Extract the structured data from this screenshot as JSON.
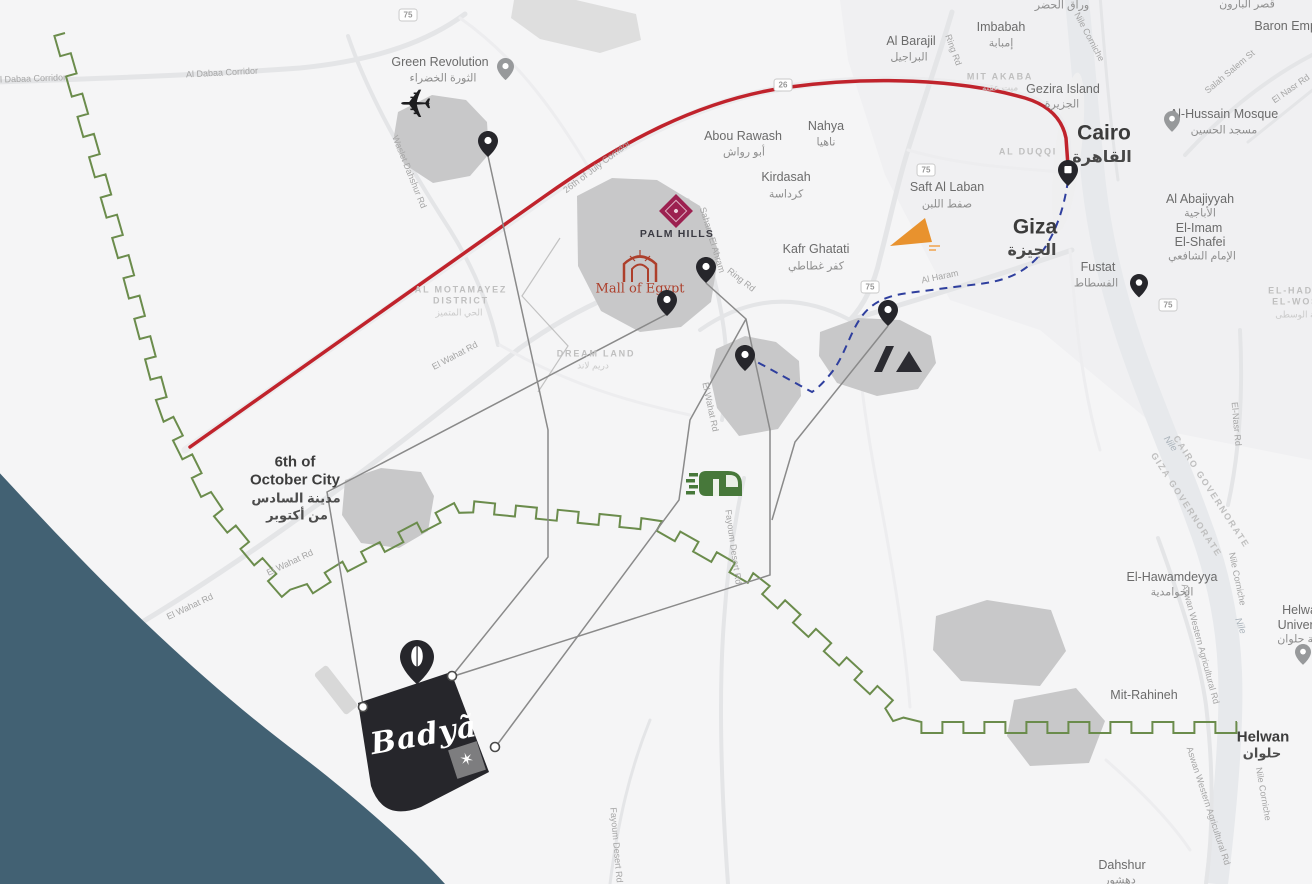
{
  "colors": {
    "red_route": "#c0232c",
    "metro_blue": "#2f3f9e",
    "boundary_green": "#6b8c4c",
    "water_teal": "#426173",
    "land": "#f5f5f6",
    "road": "#e4e5e7",
    "nile": "#e7e9ec",
    "district_blob": "#c8c8c9",
    "badya_black": "#26262b",
    "palm_hills_magenta": "#9c2150",
    "mall_red": "#ad3f2b",
    "orange_logo": "#e8922e",
    "monorail_green": "#47783a",
    "connector_gray": "#8a8a8a",
    "pin_dark": "#26262b",
    "pin_gray": "#97999b"
  },
  "icons": {
    "airport": "airplane-silhouette-icon",
    "transit": "green-monorail-icon",
    "palm_hills": "magenta-diamond-logo",
    "mall_of_egypt": "red-double-arch-logo",
    "museum": "slash-and-pyramid-logo",
    "orange_landmark": "orange-triangle-logo",
    "compass": "star-compass-square",
    "marker": "teardrop-map-pin"
  },
  "brands": {
    "badya": "Badyã",
    "palm_hills": "PALM HILLS",
    "mall_of_egypt": "Mall of Egypt"
  },
  "badges": [
    {
      "t": "75",
      "x": 408,
      "y": 15
    },
    {
      "t": "26",
      "x": 783,
      "y": 85
    },
    {
      "t": "75",
      "x": 926,
      "y": 170
    },
    {
      "t": "75",
      "x": 870,
      "y": 287
    },
    {
      "t": "75",
      "x": 1168,
      "y": 305
    }
  ],
  "pins": [
    {
      "name": "pin-green-revolution",
      "x": 505,
      "y": 66,
      "v": "gray",
      "s": 0.85
    },
    {
      "name": "pin-sphinx-airport",
      "x": 488,
      "y": 141,
      "v": "dark",
      "s": 1
    },
    {
      "name": "pin-mall-of-egypt",
      "x": 667,
      "y": 300,
      "v": "dark",
      "s": 1
    },
    {
      "name": "pin-ring-road",
      "x": 706,
      "y": 267,
      "v": "dark",
      "s": 1
    },
    {
      "name": "pin-kafr-ghatati",
      "x": 888,
      "y": 310,
      "v": "dark",
      "s": 1
    },
    {
      "name": "pin-museum-area",
      "x": 745,
      "y": 355,
      "v": "dark",
      "s": 1
    },
    {
      "name": "pin-fustat",
      "x": 1139,
      "y": 283,
      "v": "dark",
      "s": 0.9
    },
    {
      "name": "pin-al-hussain-mosque",
      "x": 1172,
      "y": 119,
      "v": "gray",
      "s": 0.8
    },
    {
      "name": "pin-helwan-university",
      "x": 1303,
      "y": 652,
      "v": "gray",
      "s": 0.8
    },
    {
      "name": "pin-cairo-metro",
      "x": 1068,
      "y": 170,
      "v": "metro",
      "s": 1
    },
    {
      "name": "pin-badya",
      "x": 417,
      "y": 656,
      "v": "badya",
      "s": 1.7
    }
  ],
  "labels": [
    {
      "t": "Al Dabaa Corridor",
      "x": 30,
      "y": 79,
      "r": -2,
      "c": "r"
    },
    {
      "t": "Al Dabaa Corridor",
      "x": 222,
      "y": 73,
      "r": -3,
      "c": "r"
    },
    {
      "t": "Green Revolution",
      "x": 440,
      "y": 62,
      "r": 0,
      "c": "t"
    },
    {
      "t": "الثورة الخضراء",
      "x": 443,
      "y": 79,
      "r": 0,
      "c": "ta"
    },
    {
      "t": "Waslet Dahshur Rd",
      "x": 409,
      "y": 172,
      "r": 68,
      "c": "r"
    },
    {
      "t": "26th of July Corridor",
      "x": 597,
      "y": 167,
      "r": -37,
      "c": "r"
    },
    {
      "t": "Abou Rawash",
      "x": 743,
      "y": 136,
      "r": 0,
      "c": "t"
    },
    {
      "t": "أبو رواش",
      "x": 744,
      "y": 153,
      "r": 0,
      "c": "ta"
    },
    {
      "t": "Nahya",
      "x": 826,
      "y": 126,
      "r": 0,
      "c": "t"
    },
    {
      "t": "ناهيا",
      "x": 826,
      "y": 143,
      "r": 0,
      "c": "ta"
    },
    {
      "t": "Kirdasah",
      "x": 786,
      "y": 177,
      "r": 0,
      "c": "t"
    },
    {
      "t": "كرداسة",
      "x": 786,
      "y": 195,
      "r": 0,
      "c": "ta"
    },
    {
      "t": "Saft Al Laban",
      "x": 947,
      "y": 187,
      "r": 0,
      "c": "t"
    },
    {
      "t": "صفط اللبن",
      "x": 947,
      "y": 205,
      "r": 0,
      "c": "ta"
    },
    {
      "t": "Kafr Ghatati",
      "x": 816,
      "y": 249,
      "r": 0,
      "c": "t"
    },
    {
      "t": "كفر غطاطي",
      "x": 816,
      "y": 267,
      "r": 0,
      "c": "ta"
    },
    {
      "t": "Al Barajil",
      "x": 911,
      "y": 41,
      "r": 0,
      "c": "t"
    },
    {
      "t": "البراجيل",
      "x": 909,
      "y": 58,
      "r": 0,
      "c": "ta"
    },
    {
      "t": "Imbabah",
      "x": 1001,
      "y": 27,
      "r": 0,
      "c": "t"
    },
    {
      "t": "إمبابة",
      "x": 1001,
      "y": 44,
      "r": 0,
      "c": "ta"
    },
    {
      "t": "Gezira Island",
      "x": 1063,
      "y": 89,
      "r": 0,
      "c": "t"
    },
    {
      "t": "الجزيرة",
      "x": 1062,
      "y": 105,
      "r": 0,
      "c": "ta"
    },
    {
      "t": "Cairo",
      "x": 1104,
      "y": 133,
      "r": 0,
      "c": "c1"
    },
    {
      "t": "القاهرة",
      "x": 1102,
      "y": 158,
      "r": 0,
      "c": "c1a"
    },
    {
      "t": "Giza",
      "x": 1035,
      "y": 227,
      "r": 0,
      "c": "c1"
    },
    {
      "t": "الجيزة",
      "x": 1032,
      "y": 251,
      "r": 0,
      "c": "c1a"
    },
    {
      "t": "Fustat",
      "x": 1098,
      "y": 267,
      "r": 0,
      "c": "t"
    },
    {
      "t": "الفسطاط",
      "x": 1096,
      "y": 284,
      "r": 0,
      "c": "ta"
    },
    {
      "t": "Al-Hussain Mosque",
      "x": 1224,
      "y": 114,
      "r": 0,
      "c": "t"
    },
    {
      "t": "مسجد الحسين",
      "x": 1224,
      "y": 131,
      "r": 0,
      "c": "ta"
    },
    {
      "t": "Baron Empain",
      "x": 1294,
      "y": 26,
      "r": 0,
      "c": "t"
    },
    {
      "t": "قصر البارون",
      "x": 1247,
      "y": 5,
      "r": 0,
      "c": "ta"
    },
    {
      "t": "وراق الحضر",
      "x": 1062,
      "y": 6,
      "r": 0,
      "c": "ta"
    },
    {
      "t": "Al Abajiyyah",
      "x": 1200,
      "y": 199,
      "r": 0,
      "c": "t"
    },
    {
      "t": "الأباجية",
      "x": 1200,
      "y": 214,
      "r": 0,
      "c": "ta"
    },
    {
      "t": "El-Imam",
      "x": 1199,
      "y": 228,
      "r": 0,
      "c": "t"
    },
    {
      "t": "El-Shafei",
      "x": 1200,
      "y": 242,
      "r": 0,
      "c": "t"
    },
    {
      "t": "الإمام الشافعي",
      "x": 1202,
      "y": 257,
      "r": 0,
      "c": "ta"
    },
    {
      "t": "MIT AKABA",
      "x": 1000,
      "y": 77,
      "r": 0,
      "c": "d"
    },
    {
      "t": "ميت عقبة",
      "x": 1000,
      "y": 88,
      "r": 0,
      "c": "da"
    },
    {
      "t": "AL DUQQI",
      "x": 1028,
      "y": 152,
      "r": 0,
      "c": "d"
    },
    {
      "t": "AL MOTAMAYEZ",
      "x": 461,
      "y": 290,
      "r": 0,
      "c": "d"
    },
    {
      "t": "DISTRICT",
      "x": 461,
      "y": 301,
      "r": 0,
      "c": "d"
    },
    {
      "t": "الحي المتميز",
      "x": 459,
      "y": 313,
      "r": 0,
      "c": "da"
    },
    {
      "t": "DREAM LAND",
      "x": 596,
      "y": 354,
      "r": 0,
      "c": "d"
    },
    {
      "t": "دريم لاند",
      "x": 593,
      "y": 366,
      "r": 0,
      "c": "da"
    },
    {
      "t": "6th of",
      "x": 295,
      "y": 462,
      "r": 0,
      "c": "c2"
    },
    {
      "t": "October City",
      "x": 295,
      "y": 480,
      "r": 0,
      "c": "c2"
    },
    {
      "t": "مدينة السادس",
      "x": 296,
      "y": 498,
      "r": 0,
      "c": "c2a"
    },
    {
      "t": "من أكتوبر",
      "x": 297,
      "y": 515,
      "r": 0,
      "c": "c2a"
    },
    {
      "t": "El Wahat Rd",
      "x": 455,
      "y": 356,
      "r": -28,
      "c": "r"
    },
    {
      "t": "El Wahat Rd",
      "x": 290,
      "y": 563,
      "r": -25,
      "c": "r"
    },
    {
      "t": "El Wahat Rd",
      "x": 190,
      "y": 607,
      "r": -25,
      "c": "r"
    },
    {
      "t": "El Wahat Rd",
      "x": 710,
      "y": 407,
      "r": 78,
      "c": "r"
    },
    {
      "t": "Sahara El Ahram",
      "x": 712,
      "y": 240,
      "r": 73,
      "c": "r"
    },
    {
      "t": "Ring Rd",
      "x": 741,
      "y": 280,
      "r": 38,
      "c": "r"
    },
    {
      "t": "Ring Rd",
      "x": 953,
      "y": 50,
      "r": 70,
      "c": "r"
    },
    {
      "t": "Al Haram",
      "x": 940,
      "y": 277,
      "r": -12,
      "c": "r"
    },
    {
      "t": "Fayoum Desert Rd",
      "x": 733,
      "y": 547,
      "r": 82,
      "c": "r"
    },
    {
      "t": "Fayoum Desert Rd",
      "x": 616,
      "y": 845,
      "r": 85,
      "c": "r"
    },
    {
      "t": "Salah Salem St",
      "x": 1230,
      "y": 72,
      "r": -40,
      "c": "r"
    },
    {
      "t": "El Nasr Rd",
      "x": 1291,
      "y": 89,
      "r": -35,
      "c": "r"
    },
    {
      "t": "El-Nasr Rd",
      "x": 1236,
      "y": 424,
      "r": 85,
      "c": "r"
    },
    {
      "t": "Nile Corniche",
      "x": 1089,
      "y": 37,
      "r": 62,
      "c": "r"
    },
    {
      "t": "Nile Corniche",
      "x": 1237,
      "y": 579,
      "r": 78,
      "c": "r"
    },
    {
      "t": "Nile Corniche",
      "x": 1263,
      "y": 794,
      "r": 80,
      "c": "r"
    },
    {
      "t": "Nile",
      "x": 1170,
      "y": 444,
      "r": 55,
      "c": "w"
    },
    {
      "t": "Nile",
      "x": 1240,
      "y": 626,
      "r": 70,
      "c": "w"
    },
    {
      "t": "Aswan Western Agricultural Rd",
      "x": 1200,
      "y": 644,
      "r": 75,
      "c": "r"
    },
    {
      "t": "Aswan Western Agricultural Rd",
      "x": 1208,
      "y": 806,
      "r": 72,
      "c": "r"
    },
    {
      "t": "GIZA GOVERNORATE",
      "x": 1186,
      "y": 505,
      "r": 57,
      "c": "d"
    },
    {
      "t": "CAIRO GOVERNORATE",
      "x": 1211,
      "y": 492,
      "r": 57,
      "c": "d"
    },
    {
      "t": "El-Hawamdeyya",
      "x": 1172,
      "y": 577,
      "r": 0,
      "c": "t"
    },
    {
      "t": "الحوامدية",
      "x": 1172,
      "y": 593,
      "r": 0,
      "c": "ta"
    },
    {
      "t": "Mit-Rahineh",
      "x": 1144,
      "y": 695,
      "r": 0,
      "c": "t"
    },
    {
      "t": "Helwan",
      "x": 1263,
      "y": 737,
      "r": 0,
      "c": "c2"
    },
    {
      "t": "حلوان",
      "x": 1262,
      "y": 753,
      "r": 0,
      "c": "c2a"
    },
    {
      "t": "Helwan",
      "x": 1303,
      "y": 610,
      "r": 0,
      "c": "t"
    },
    {
      "t": "University",
      "x": 1305,
      "y": 625,
      "r": 0,
      "c": "t"
    },
    {
      "t": "جامعة حلوان",
      "x": 1306,
      "y": 640,
      "r": 0,
      "c": "ta"
    },
    {
      "t": "Dahshur",
      "x": 1122,
      "y": 865,
      "r": 0,
      "c": "t"
    },
    {
      "t": "دهشور",
      "x": 1120,
      "y": 881,
      "r": 0,
      "c": "ta"
    },
    {
      "t": "EL-HADABA",
      "x": 1303,
      "y": 291,
      "r": 0,
      "c": "d"
    },
    {
      "t": "EL-WOSTA",
      "x": 1303,
      "y": 302,
      "r": 0,
      "c": "d"
    },
    {
      "t": "الهضبة الوسطى",
      "x": 1305,
      "y": 315,
      "r": 0,
      "c": "da"
    },
    {
      "t": "PALM HILLS",
      "x": 677,
      "y": 234,
      "r": 0,
      "c": "bph"
    },
    {
      "t": "Mall of Egypt",
      "x": 640,
      "y": 289,
      "r": 0,
      "c": "bmoe"
    },
    {
      "t": "Badyã",
      "x": 424,
      "y": 736,
      "r": -10,
      "c": "bbad"
    }
  ]
}
